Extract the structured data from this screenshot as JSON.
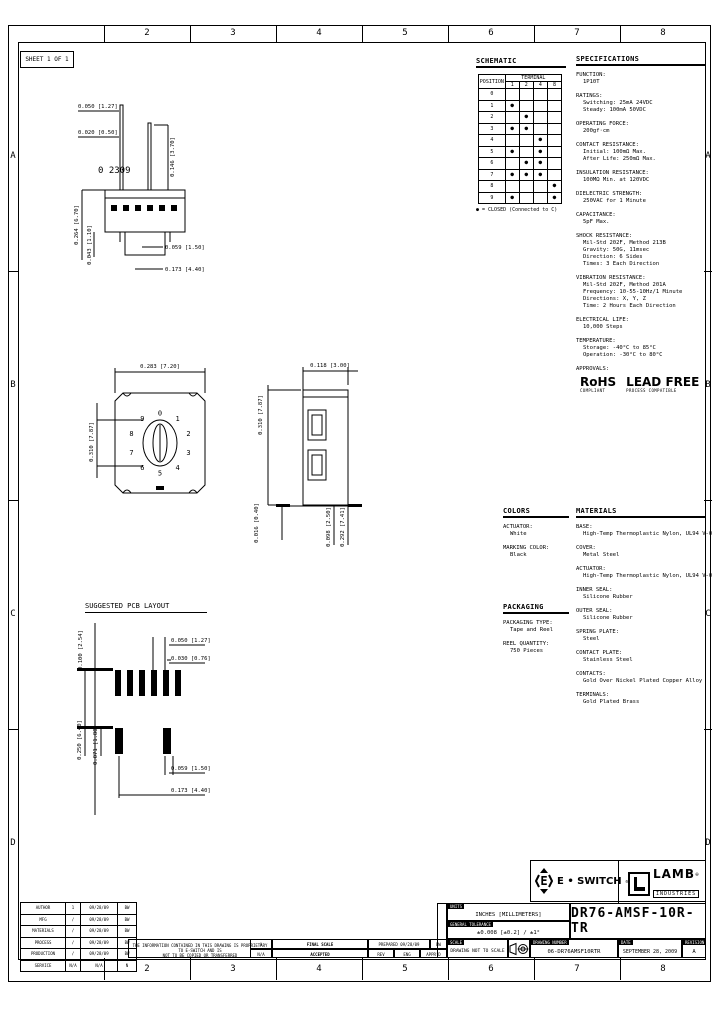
{
  "sheet": {
    "label": "SHEET 1 OF 1"
  },
  "zones": {
    "columns": [
      "2",
      "3",
      "4",
      "5",
      "6",
      "7",
      "8"
    ],
    "rows": [
      "A",
      "B",
      "C",
      "D"
    ]
  },
  "schematic": {
    "title": "SCHEMATIC",
    "col_position": "POSITION",
    "col_terminal": "TERMINAL",
    "terminals": [
      "1",
      "2",
      "4",
      "8"
    ],
    "rows": [
      {
        "pos": "0",
        "closed": []
      },
      {
        "pos": "1",
        "closed": [
          "1"
        ]
      },
      {
        "pos": "2",
        "closed": [
          "2"
        ]
      },
      {
        "pos": "3",
        "closed": [
          "1",
          "2"
        ]
      },
      {
        "pos": "4",
        "closed": [
          "4"
        ]
      },
      {
        "pos": "5",
        "closed": [
          "1",
          "4"
        ]
      },
      {
        "pos": "6",
        "closed": [
          "2",
          "4"
        ]
      },
      {
        "pos": "7",
        "closed": [
          "1",
          "2",
          "4"
        ]
      },
      {
        "pos": "8",
        "closed": [
          "8"
        ]
      },
      {
        "pos": "9",
        "closed": [
          "1",
          "8"
        ]
      }
    ],
    "legend": "● = CLOSED (Connected to C)"
  },
  "specifications": {
    "title": "SPECIFICATIONS",
    "sections": [
      {
        "label": "FUNCTION:",
        "lines": [
          "1P10T"
        ]
      },
      {
        "label": "RATINGS:",
        "lines": [
          "Switching: 25mA 24VDC",
          "Steady: 100mA 50VDC"
        ]
      },
      {
        "label": "OPERATING FORCE:",
        "lines": [
          "200gf·cm"
        ]
      },
      {
        "label": "CONTACT RESISTANCE:",
        "lines": [
          "Initial: 100mΩ Max.",
          "After Life: 250mΩ Max."
        ]
      },
      {
        "label": "INSULATION RESISTANCE:",
        "lines": [
          "100MΩ Min. at 120VDC"
        ]
      },
      {
        "label": "DIELECTRIC STRENGTH:",
        "lines": [
          "250VAC for 1 Minute"
        ]
      },
      {
        "label": "CAPACITANCE:",
        "lines": [
          "5pF Max."
        ]
      },
      {
        "label": "SHOCK RESISTANCE:",
        "lines": [
          "Mil-Std 202F, Method 213B",
          "Gravity: 50G, 11msec",
          "Direction: 6 Sides",
          "Times: 3 Each Direction"
        ]
      },
      {
        "label": "VIBRATION RESISTANCE:",
        "lines": [
          "Mil-Std 202F, Method 201A",
          "Frequency: 10-55-10Hz/1 Minute",
          "Directions: X, Y, Z",
          "Time: 2 Hours Each Direction"
        ]
      },
      {
        "label": "ELECTRICAL LIFE:",
        "lines": [
          "10,000 Steps"
        ]
      },
      {
        "label": "TEMPERATURE:",
        "lines": [
          "Storage: -40°C to 85°C",
          "Operation: -30°C to 80°C"
        ]
      }
    ],
    "approvals_label": "APPROVALS:",
    "rohs": "RoHS",
    "rohs_sub": "COMPLIANT",
    "lead": "LEAD FREE",
    "lead_sub": "PROCESS COMPATIBLE"
  },
  "colors": {
    "title": "COLORS",
    "sections": [
      {
        "label": "ACTUATOR:",
        "lines": [
          "White"
        ]
      },
      {
        "label": "MARKING COLOR:",
        "lines": [
          "Black"
        ]
      }
    ]
  },
  "packaging": {
    "title": "PACKAGING",
    "sections": [
      {
        "label": "PACKAGING TYPE:",
        "lines": [
          "Tape and Reel"
        ]
      },
      {
        "label": "REEL QUANTITY:",
        "lines": [
          "750 Pieces"
        ]
      }
    ]
  },
  "materials": {
    "title": "MATERIALS",
    "sections": [
      {
        "label": "BASE:",
        "lines": [
          "High-Temp Thermoplastic Nylon, UL94 V-0"
        ]
      },
      {
        "label": "COVER:",
        "lines": [
          "Metal Steel"
        ]
      },
      {
        "label": "ACTUATOR:",
        "lines": [
          "High-Temp Thermoplastic Nylon, UL94 V-0"
        ]
      },
      {
        "label": "INNER SEAL:",
        "lines": [
          "Silicone Rubber"
        ]
      },
      {
        "label": "OUTER SEAL:",
        "lines": [
          "Silicone Rubber"
        ]
      },
      {
        "label": "SPRING PLATE:",
        "lines": [
          "Steel"
        ]
      },
      {
        "label": "CONTACT PLATE:",
        "lines": [
          "Stainless Steel"
        ]
      },
      {
        "label": "CONTACTS:",
        "lines": [
          "Gold Over Nickel Plated Copper Alloy"
        ]
      },
      {
        "label": "TERMINALS:",
        "lines": [
          "Gold Plated Brass"
        ]
      }
    ]
  },
  "views": {
    "front": {
      "marking": "0 2309",
      "dims": {
        "d1": "0.050 [1.27]",
        "d2": "0.020 [0.50]",
        "d3": "0.146 [3.70]",
        "d4": "0.264 [6.70]",
        "d5": "0.043 [1.10]",
        "d6": "0.059 [1.50]",
        "d7": "0.173 [4.40]"
      }
    },
    "top": {
      "dims": {
        "width": "0.283 [7.20]",
        "height": "0.310 [7.87]"
      },
      "dial_digits": [
        "0",
        "1",
        "2",
        "3",
        "4",
        "5",
        "6",
        "7",
        "8",
        "9"
      ]
    },
    "side": {
      "dims": {
        "top": "0.118 [3.00]",
        "left": "0.310 [7.87]",
        "bottom_left": "0.016 [0.40]",
        "b1": "0.098 [2.50]",
        "b2": "0.292 [7.41]"
      }
    },
    "pcb": {
      "title": "SUGGESTED PCB LAYOUT",
      "dims": {
        "pitch": "0.050 [1.27]",
        "pad": "0.030 [0.76]",
        "left_upper": "0.100 [2.54]",
        "low1": "0.059 [1.50]",
        "low2": "0.173 [4.40]",
        "left_a": "0.250 [6.40]",
        "left_b": "0.071 [1.80]"
      }
    }
  },
  "titleblock": {
    "signoff_rows": [
      [
        "AUTHOR",
        "1",
        "09/28/09",
        "BW"
      ],
      [
        "MFG",
        "/",
        "09/28/09",
        "BW"
      ],
      [
        "MATERIALS",
        "/",
        "09/28/09",
        "BW"
      ],
      [
        "PROCESS",
        "/",
        "09/28/09",
        "BW"
      ],
      [
        "PRODUCTION",
        "/",
        "09/28/09",
        "BW"
      ],
      [
        "SERVICE",
        "N/A",
        "N/A",
        "N"
      ]
    ],
    "disclaimer_line1": "THE INFORMATION CONTAINED IN THIS DRAWING IS PROPRIETARY TO E-SWITCH AND IS",
    "disclaimer_line2": "NOT TO BE COPIED OR TRANSFERRED",
    "disclaimer_rev": "A",
    "disclaimer_na": "N/A",
    "final_scale_label": "FINAL SCALE",
    "accepted_label": "ACCEPTED",
    "prepared_label": "PREPARED",
    "prepared_date": "09/28/09",
    "prepared_by": "BW",
    "rev_label": "REV",
    "eng_label": "ENG",
    "appr_label": "APPR'D",
    "units_label": "UNITS",
    "units_value": "INCHES [MILLIMETERS]",
    "tolerance_label": "GENERAL TOLERANCE",
    "tolerance_value": "±0.008 [±0.2] / ±1°",
    "scale_label": "SCALE",
    "scale_value": "DRAWING NOT TO SCALE",
    "part_number": "DR76-AMSF-10R-TR",
    "drawing_number_label": "DRAWING NUMBER",
    "drawing_number": "06-DR76AMSF10RTR",
    "date_label": "DATE",
    "date_value": "SEPTEMBER 28, 2009",
    "revision_label": "REVISION",
    "revision_value": "A"
  },
  "logos": {
    "eswitch": "E • SWITCH",
    "eswitch_reg": "®",
    "lamb": "LAMB",
    "lamb_reg": "®",
    "lamb_sub": "INDUSTRIES"
  }
}
